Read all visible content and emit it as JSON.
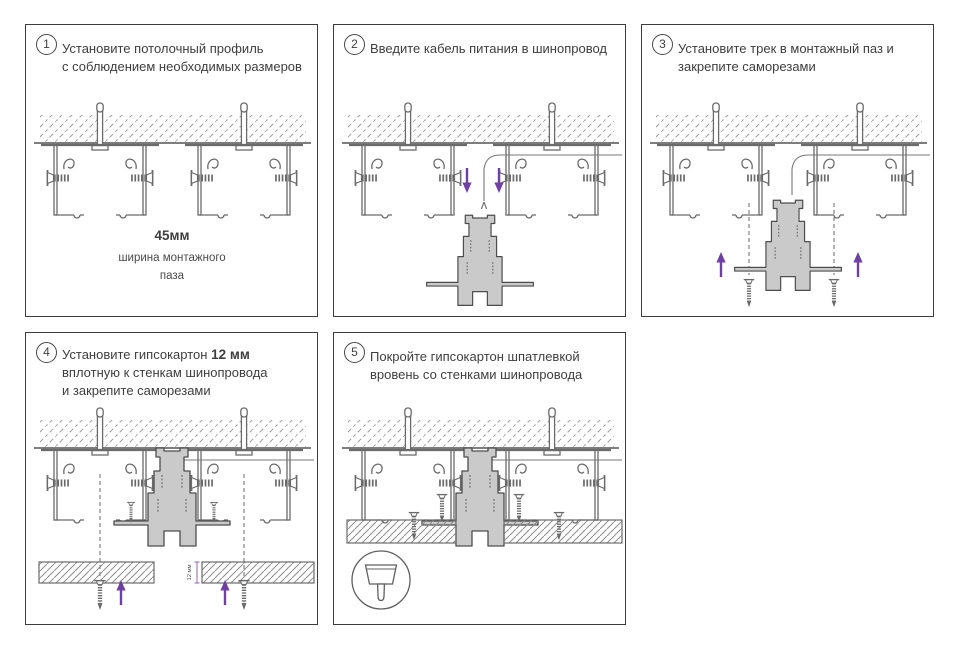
{
  "page": {
    "background": "#ffffff"
  },
  "colors": {
    "line_art": "#6b6b6b",
    "track_outline": "#4d4d4d",
    "track_fill": "#cacaca",
    "text": "#3e3e3e",
    "accent_arrow": "#6F3FA5",
    "panel_border": "#3c3c3c"
  },
  "steps": [
    {
      "number": "1",
      "line1": "Установите потолочный профиль",
      "line2": "с соблюдением необходимых размеров",
      "dim_value": "45мм",
      "dim_caption_1": "ширина монтажного",
      "dim_caption_2": "паза"
    },
    {
      "number": "2",
      "line1": "Введите кабель питания в шинопровод"
    },
    {
      "number": "3",
      "line1": "Установите трек в монтажный паз и",
      "line2": "закрепите саморезами"
    },
    {
      "number": "4",
      "line1_prefix": "Установите гипсокартон ",
      "line1_bold": "12 мм",
      "line2": "вплотную к стенкам шинопровода",
      "line3": "и закрепите саморезами",
      "board_thickness_label": "12 мм"
    },
    {
      "number": "5",
      "line1": "Покройте гипсокартон шпатлевкой",
      "line2": "вровень со стенками шинопровода"
    }
  ]
}
